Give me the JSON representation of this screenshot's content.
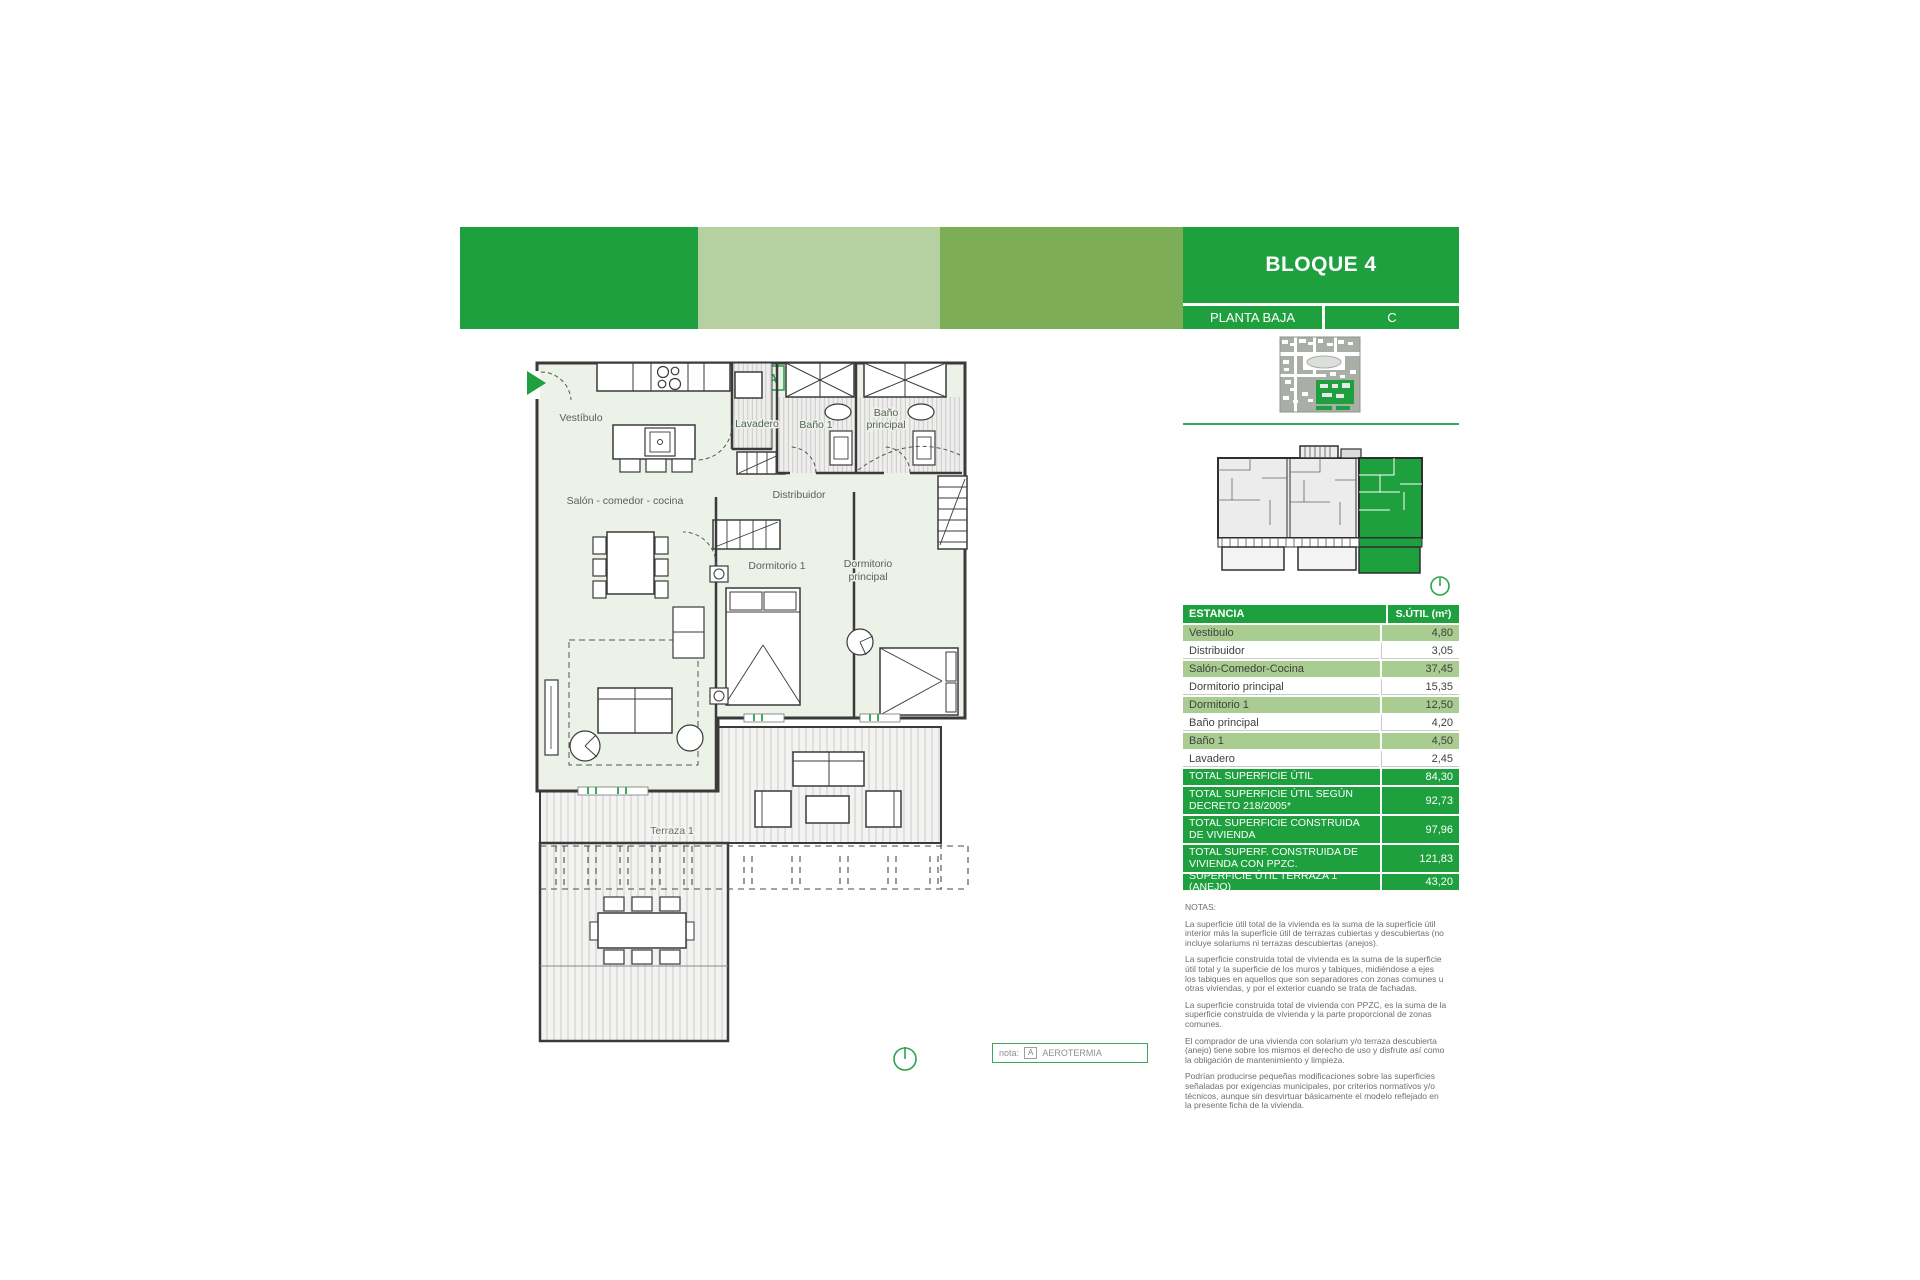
{
  "header": {
    "title": "BLOQUE 4",
    "floor_label": "PLANTA BAJA",
    "unit_letter": "C"
  },
  "plan": {
    "unit_badge": "A",
    "rooms": {
      "vestibulo": "Vestíbulo",
      "salon": "Salón - comedor - cocina",
      "lavadero": "Lavadero",
      "bano1": "Baño 1",
      "bano_principal_l1": "Baño",
      "bano_principal_l2": "principal",
      "distribuidor": "Distribuidor",
      "dormitorio1": "Dormitorio 1",
      "dormitorio_principal_l1": "Dormitorio",
      "dormitorio_principal_l2": "principal",
      "terraza": "Terraza 1"
    }
  },
  "table": {
    "header": {
      "estancia": "ESTANCIA",
      "sutil": "S.ÚTIL (m²)"
    },
    "rows": [
      {
        "label": "Vestibulo",
        "value": "4,80"
      },
      {
        "label": "Distribuidor",
        "value": "3,05"
      },
      {
        "label": "Salón-Comedor-Cocina",
        "value": "37,45"
      },
      {
        "label": "Dormitorio principal",
        "value": "15,35"
      },
      {
        "label": "Dormitorio 1",
        "value": "12,50"
      },
      {
        "label": "Baño principal",
        "value": "4,20"
      },
      {
        "label": "Baño 1",
        "value": "4,50"
      },
      {
        "label": "Lavadero",
        "value": "2,45"
      }
    ],
    "totals": [
      {
        "label": "TOTAL SUPERFICIE ÚTIL",
        "value": "84,30"
      },
      {
        "label": "TOTAL SUPERFICIE ÚTIL SEGÚN DECRETO 218/2005*",
        "value": "92,73"
      },
      {
        "label": "TOTAL SUPERFICIE CONSTRUIDA DE VIVIENDA",
        "value": "97,96"
      },
      {
        "label": "TOTAL SUPERF. CONSTRUIDA DE VIVIENDA CON PPZC.",
        "value": "121,83"
      },
      {
        "label": "SUPERFICIE ÚTIL TERRAZA 1 (ANEJO)",
        "value": "43,20"
      }
    ]
  },
  "notes": {
    "heading": "NOTAS:",
    "paragraphs": [
      "La superficie útil total de la vivienda es la suma de la superficie útil interior más la superficie útil de terrazas cubiertas y descubiertas (no incluye solariums ni terrazas descubiertas (anejos).",
      "La superficie construida total de vivienda es la suma de la superficie útil total y la superficie de los muros y tabiques, midiéndose a ejes los tabiques en aquellos que son separadores con zonas comunes u otras viviendas, y por el exterior cuando se trata de fachadas.",
      "La superficie construida total de vivienda con PPZC, es la suma de la superficie construida de vivienda y la parte proporcional de zonas comunes.",
      "El comprador de una vivienda con solarium y/o terraza descubierta (anejo) tiene sobre los mismos el derecho de uso y disfrute así como la obligación de mantenimiento y limpieza.",
      "Podrían producirse pequeñas modificaciones sobre las superficies señaladas por exigencias municipales, por criterios normativos y/o técnicos, aunque sin desvirtuar básicamente el modelo reflejado en la presente ficha de la vivienda."
    ]
  },
  "nota_box": {
    "label": "nota:",
    "badge": "A",
    "text": "AEROTERMIA"
  },
  "colors": {
    "green_dark": "#1ea03f",
    "green_medium": "#7ead57",
    "green_pale": "#b6d0a1",
    "green_row": "#a9cc90"
  }
}
